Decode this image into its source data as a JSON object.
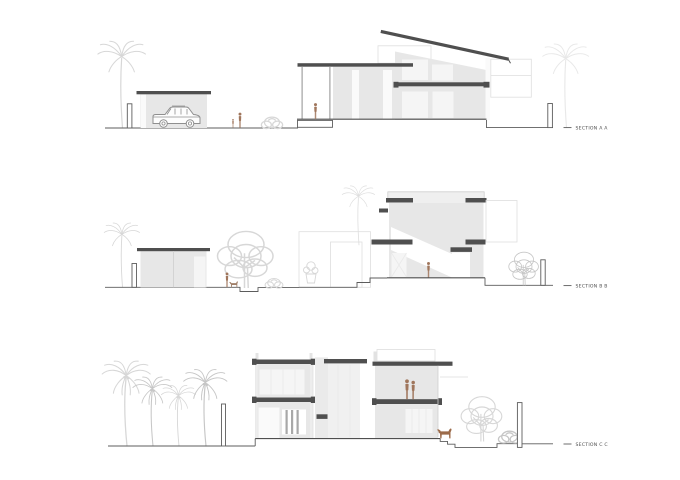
{
  "document": {
    "type": "architectural-section-sheet",
    "sheet_title": "Residential building sections"
  },
  "colors": {
    "background": "#ffffff",
    "cut_slab": "#4f4f4f",
    "wall_fill": "#e7e7e7",
    "window_fill": "#f5f5f5",
    "ground_line": "#5c5c5c",
    "faint_outline": "#dedede",
    "vegetation": "#d7d7d7",
    "vegetation_dark": "#c6c6c6",
    "figure": "#a0765c",
    "car_line": "#8f8f8f",
    "label_text": "#4d4d4d"
  },
  "sections": [
    {
      "id": "aa",
      "label": "SECTION A A"
    },
    {
      "id": "bb",
      "label": "SECTION B B"
    },
    {
      "id": "cc",
      "label": "SECTION C C"
    }
  ]
}
